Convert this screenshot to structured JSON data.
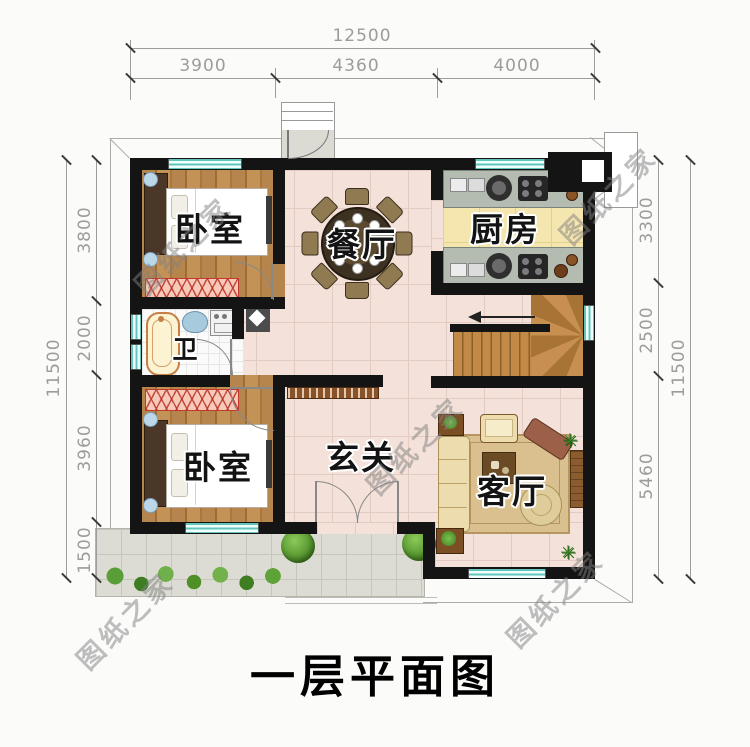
{
  "plan": {
    "title": "一层平面图",
    "watermark": "图纸之家",
    "rooms": {
      "bedroom_top": "卧室",
      "dining": "餐厅",
      "kitchen": "厨房",
      "bathroom": "卫",
      "bedroom_bottom": "卧室",
      "foyer": "玄关",
      "living": "客厅"
    },
    "dimensions": {
      "top": {
        "total": "12500",
        "segments": [
          "3900",
          "4360",
          "4000"
        ]
      },
      "left": {
        "total": "11500",
        "segments": [
          "3800",
          "2000",
          "3960",
          "1500"
        ]
      },
      "right": {
        "total": "11500",
        "segments": [
          "3300",
          "2500",
          "5460"
        ]
      }
    },
    "colors": {
      "wall": "#141414",
      "window": "#63c4ba",
      "wood_floor": "#b6854d",
      "tile_floor": "#f4e2da",
      "kitchen_floor": "#f5e6b0",
      "terrace": "#dcdcd4",
      "dim_text": "#9c9c9c"
    }
  }
}
